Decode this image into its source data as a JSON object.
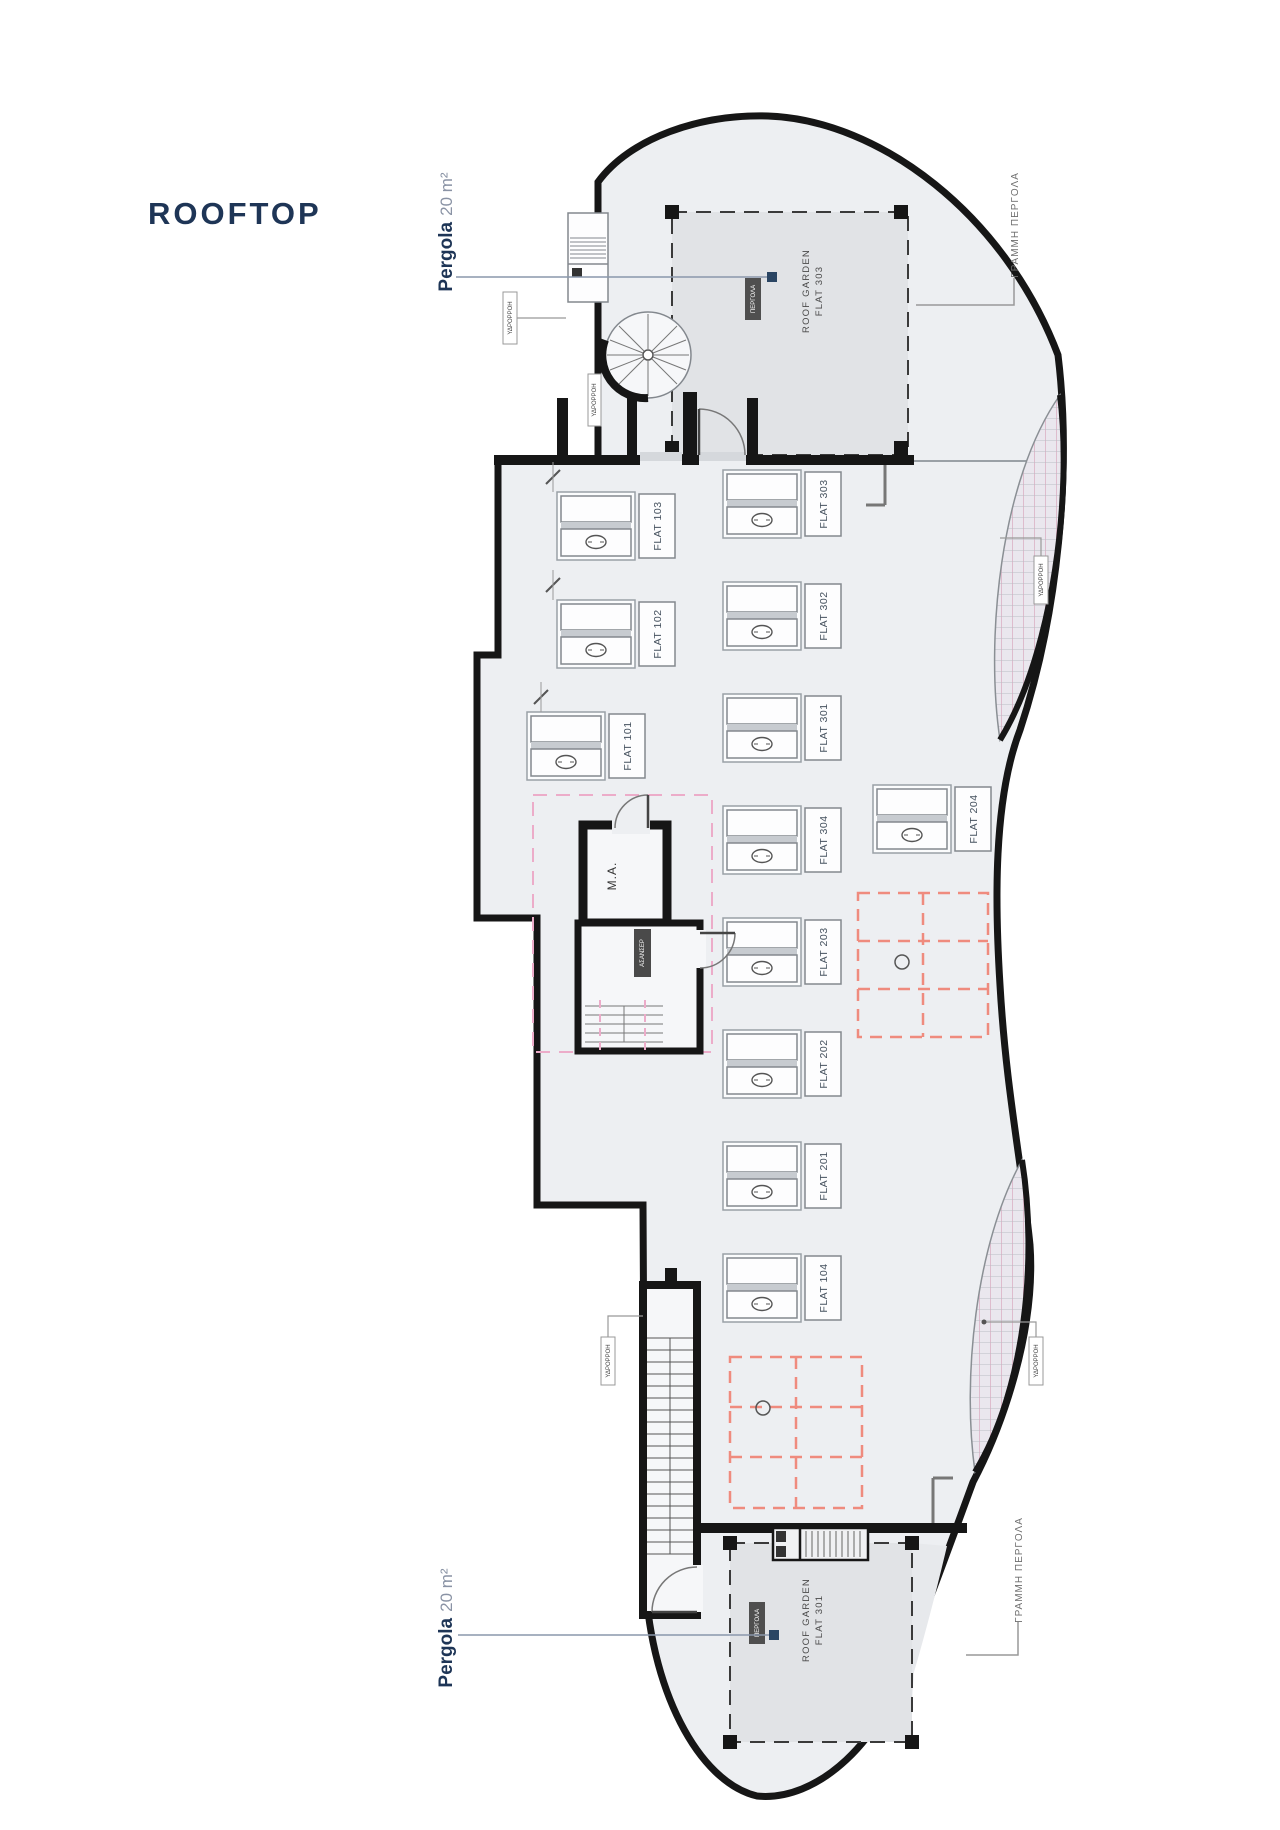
{
  "title": "ROOFTOP",
  "colors": {
    "navy": "#1e3556",
    "wall": "#161616",
    "interior": "#edeff2",
    "pergola_shade": "#e1e3e6",
    "pink_grid": "#ef8b7e",
    "pink_core": "#ecacc9",
    "hatch_pink": "#d9a9bf",
    "leader": "#8a97ab"
  },
  "pergolas": {
    "top": {
      "name": "Pergola",
      "area": "20 m²",
      "badge": "ΠΕΡΓΟΛΑ",
      "garden_line1": "ROOF GARDEN",
      "garden_line2": "FLAT 303"
    },
    "bottom": {
      "name": "Pergola",
      "area": "20 m²",
      "badge": "ΠΕΡΓΟΛΑ",
      "garden_line1": "ROOF GARDEN",
      "garden_line2": "FLAT 301"
    }
  },
  "flats": {
    "left_column": [
      "FLAT 103",
      "FLAT 102",
      "FLAT 101"
    ],
    "right_column": [
      "FLAT 303",
      "FLAT 302",
      "FLAT 301",
      "FLAT 304",
      "FLAT 203",
      "FLAT 202",
      "FLAT 201",
      "FLAT 104"
    ],
    "isolated": "FLAT 204"
  },
  "core": {
    "machine_room": "M.A.",
    "elevator_badge": "ΑΣΑΝΣΕΡ"
  },
  "annotations": {
    "pergola_line_top": "ΓΡΑΜΜΗ ΠΕΡΓΟΛΑ",
    "pergola_line_bottom": "ΓΡΑΜΜΗ ΠΕΡΓΟΛΑ",
    "downspout": "ΥΔΡΟΡΡΟΗ"
  }
}
